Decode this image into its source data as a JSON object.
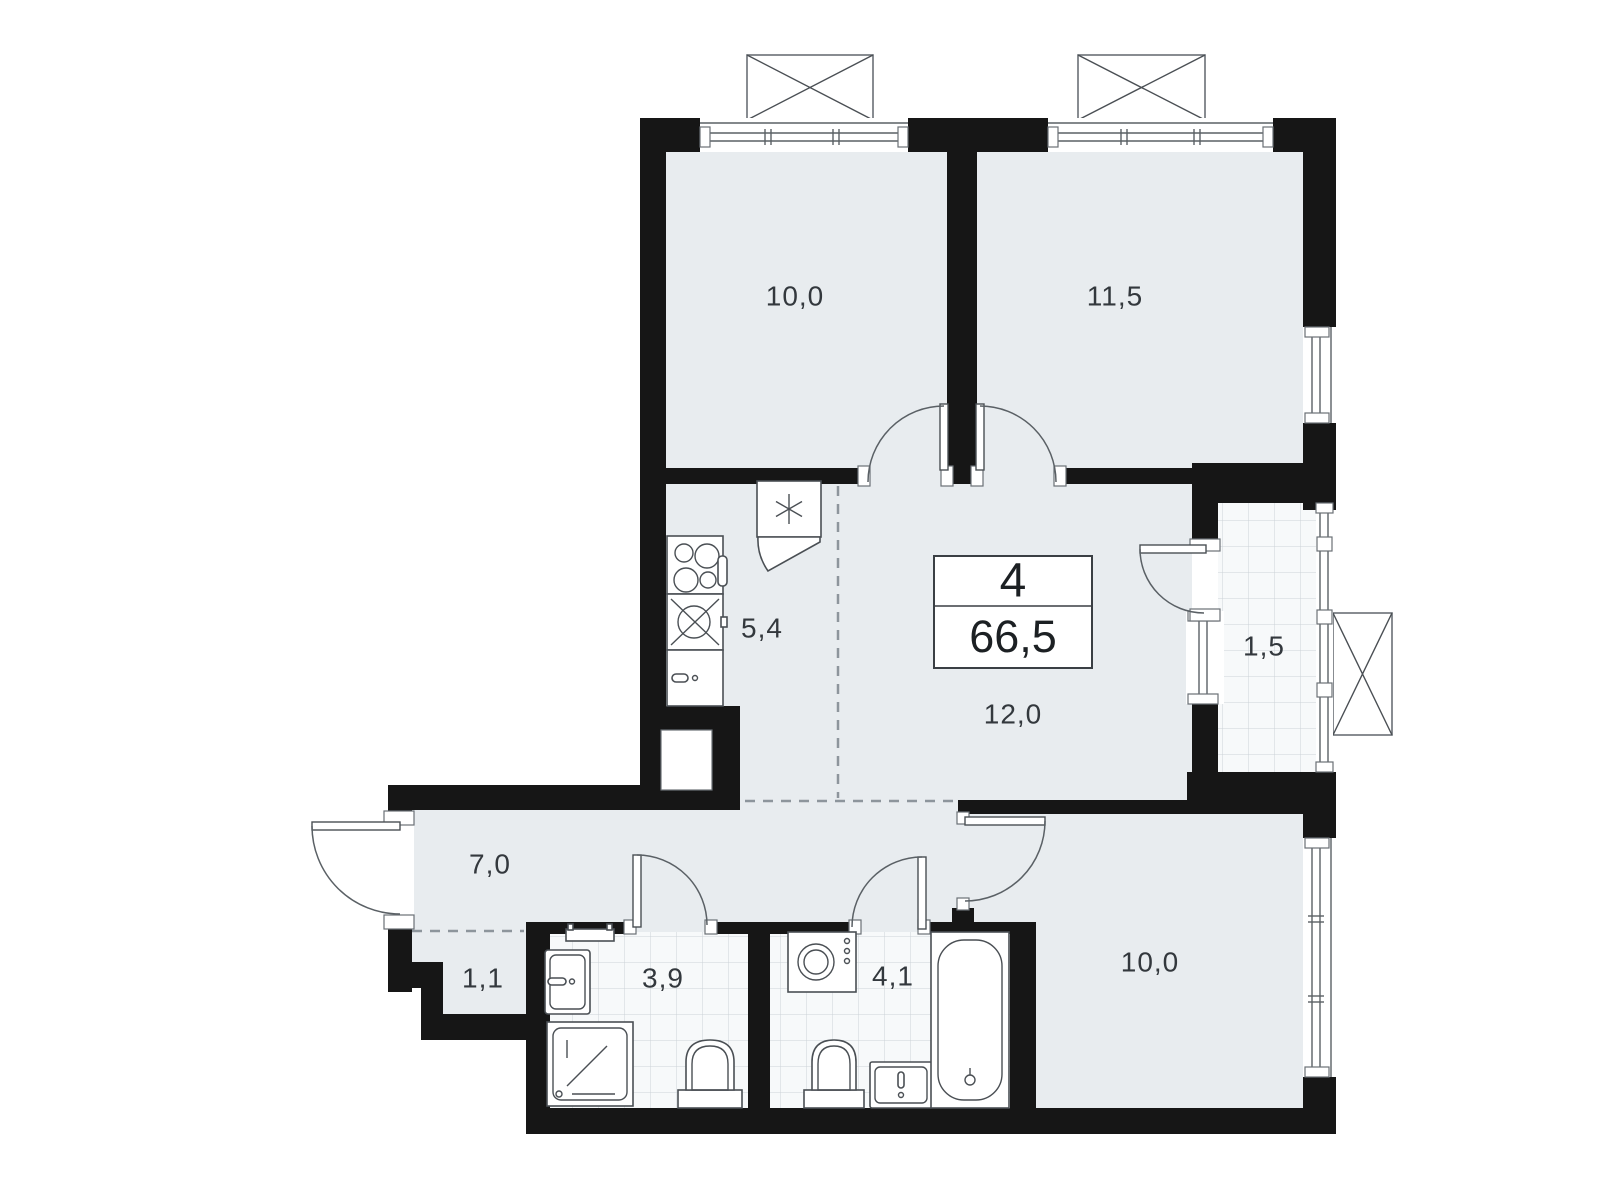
{
  "title": "Apartment floor plan",
  "summary": {
    "rooms_count": "4",
    "total_area": "66,5"
  },
  "rooms": [
    {
      "name": "bedroom-top-left",
      "area": "10,0"
    },
    {
      "name": "bedroom-top-right",
      "area": "11,5"
    },
    {
      "name": "kitchen",
      "area": "5,4"
    },
    {
      "name": "living-room",
      "area": "12,0"
    },
    {
      "name": "balcony",
      "area": "1,5"
    },
    {
      "name": "hallway",
      "area": "7,0"
    },
    {
      "name": "closet",
      "area": "1,1"
    },
    {
      "name": "bathroom-shower",
      "area": "3,9"
    },
    {
      "name": "bathroom-tub",
      "area": "4,1"
    },
    {
      "name": "bedroom-bottom",
      "area": "10,0"
    }
  ],
  "icons": [
    "ac-unit-icon",
    "vent-shaft-icon",
    "stove-icon",
    "kitchen-sink-icon",
    "kitchen-cabinet-icon",
    "towel-rail-icon",
    "washbasin-icon",
    "shower-icon",
    "toilet-icon",
    "washing-machine-icon",
    "vanity-sink-icon",
    "bathtub-icon",
    "window-icon",
    "door-arc-icon"
  ],
  "colors": {
    "wall": "#161616",
    "floor": "#e8ecef",
    "tile_floor": "#f7f9fa",
    "tile_line": "#ccd3d8",
    "outline": "#4a4f54",
    "dash_line": "#8d959c",
    "label_text": "#33383d",
    "background": "#ffffff"
  }
}
